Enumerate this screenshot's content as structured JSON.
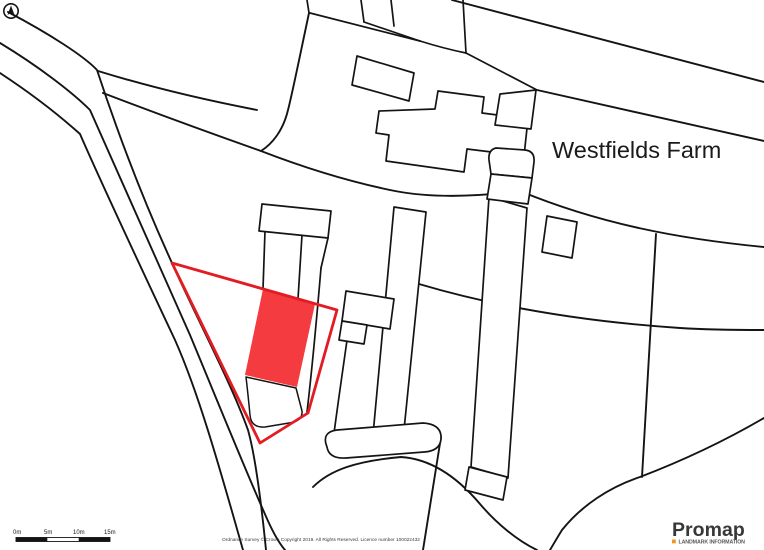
{
  "map": {
    "place_label": "Westfields Farm",
    "colors": {
      "background": "#ffffff",
      "linework": "#141414",
      "plot_outline": "#e31c23",
      "plot_fill": "#f43b3f"
    }
  },
  "scale_bar": {
    "labels": [
      "0m",
      "5m",
      "10m",
      "15m"
    ]
  },
  "attribution": "Ordnance Survey © Crown Copyright 2019. All Rights Reserved. Licence number 100022432",
  "branding": {
    "name": "Promap",
    "tagline": "LANDMARK INFORMATION",
    "accent": "#f7941d"
  }
}
